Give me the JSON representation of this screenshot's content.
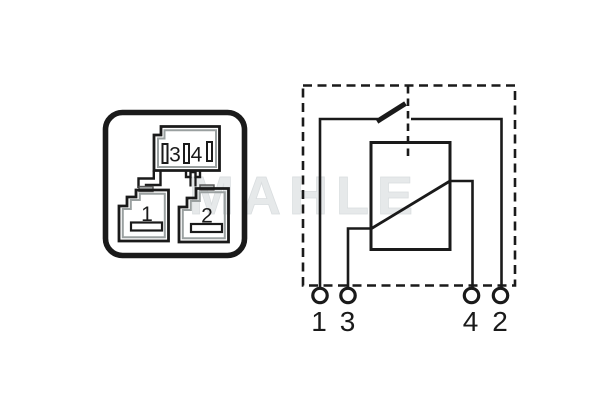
{
  "diagram": {
    "title_hint": "relay pinout and circuit schematic",
    "watermark": "MAHLE",
    "socket_view": {
      "pin3_label": "3",
      "pin4_label": "4",
      "pin1_label": "1",
      "pin2_label": "2"
    },
    "schematic": {
      "terminal_labels": [
        "1",
        "3",
        "4",
        "2"
      ]
    },
    "colors": {
      "line": "#1a1a1a",
      "molding_gray": "#9aa0a0",
      "tab_gray": "#b0b4b4",
      "watermark_gray": "#e6e9ea",
      "background": "#ffffff"
    }
  }
}
